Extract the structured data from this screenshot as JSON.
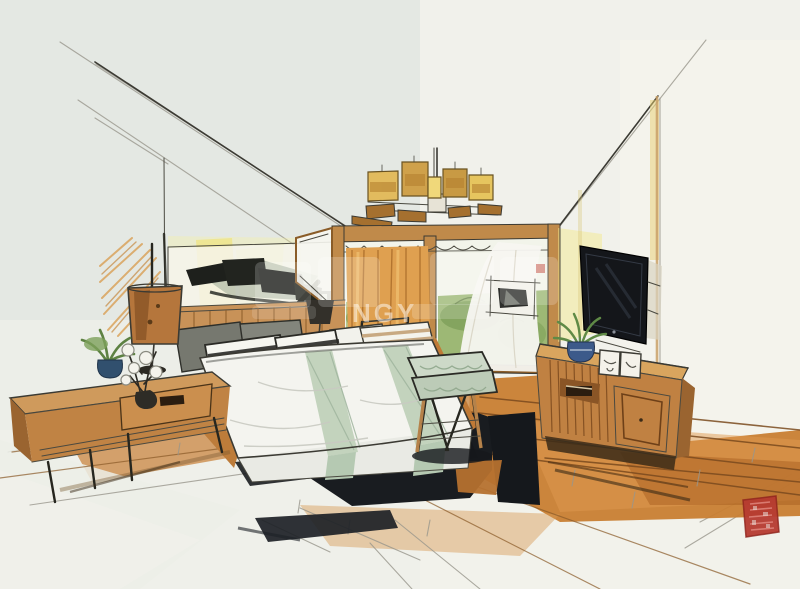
{
  "artwork": {
    "description": "Hand-drawn interior design marker and ink sketch of a modern bedroom in two-point perspective"
  },
  "watermark": {
    "visible_letters": "NGY"
  },
  "seal": {
    "label": "red square artist seal stamp"
  },
  "scene": {
    "ceiling": "white ceiling with perspective construction lines",
    "chandelier": "five-shade amber and wood chandelier",
    "wall_art": "wide abstract black-ink artwork above headboard",
    "accent_wall": "yellow and orange marker wall accents",
    "headboard": "slatted wood headboard",
    "bed": "double bed with white duvet and sage green runners",
    "pillows": "black-and-white striped, tan striped and gray pillows",
    "bench": "foot-of-bed wooden bench with mint tufted cushion",
    "rug": "dark navy area rug with tan patches",
    "nightstand": "wooden nightstand with drawer and lower shelf",
    "table_lamp": "copper drum-shade table lamp",
    "nightstand_plant": "small potted green plant",
    "flower_twigs": "dark twigs with white blossoms",
    "window": "floor-to-ceiling wood-framed balcony window",
    "open_pane": "glass door pane swung open",
    "curtain": "orange pleated curtain",
    "foliage": "green foliage seen outside the glass",
    "sheer_curtain": "white sheer curtain arch",
    "framed_art": "small framed abstract picture",
    "side_chair": "wooden chair with striped cushion by the window",
    "small_lamp": "dark-shade lamp on far nightstand",
    "tv": "wall-mounted flat-screen television",
    "tv_console": "slatted wooden media console",
    "console_plant": "green plant in blue vase",
    "photo_frames": "two small picture frames on console",
    "floor": "orange-stained wood plank floor fading to bare paper"
  },
  "palette": {
    "paper": "#eceee8",
    "paper_cool": "#dfe3df",
    "ink": "#3b3a33",
    "pencil": "#98968c",
    "wood": "#c08142",
    "wood_light": "#d9a55e",
    "floor_orange": "#c87e33",
    "floor_deep": "#a35b1d",
    "curtain_orange": "#dfa050",
    "foliage_green": "#8fae62",
    "yellow_wash": "#f2e25c",
    "rug_dark": "#191c20",
    "sage": "#c3d3bd",
    "tv_screen": "#14161a",
    "seal_red": "#b53a30"
  }
}
